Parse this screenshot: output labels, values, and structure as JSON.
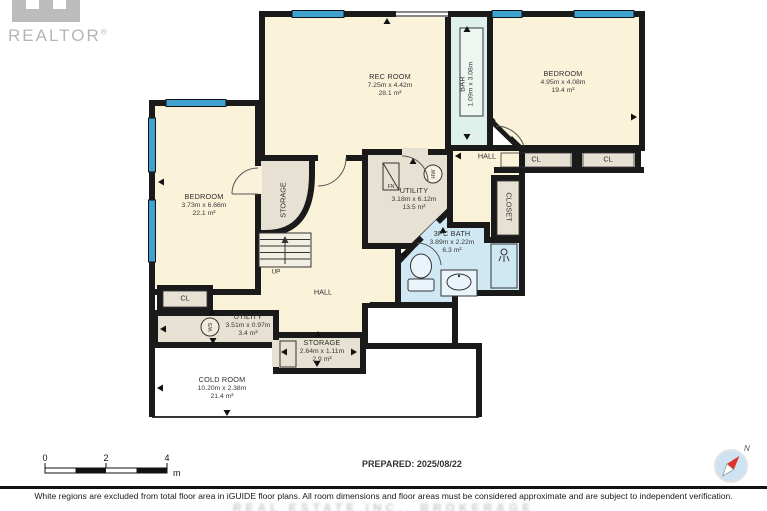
{
  "branding": {
    "realtor": "REALTOR",
    "reg": "®"
  },
  "rooms": {
    "rec_room": {
      "name": "REC ROOM",
      "dims": "7.25m x 4.42m",
      "area": "28.1 m²"
    },
    "bar": {
      "name": "BAR",
      "dims": "1.09m x 3.08m"
    },
    "bedroom_right": {
      "name": "BEDROOM",
      "dims": "4.95m x 4.08m",
      "area": "19.4 m²"
    },
    "bedroom_left": {
      "name": "BEDROOM",
      "dims": "3.73m x 6.66m",
      "area": "22.1 m²"
    },
    "utility_main": {
      "name": "UTILITY",
      "dims": "3.18m x 6.12m",
      "area": "13.5 m²"
    },
    "bath": {
      "name": "3PC BATH",
      "dims": "3.89m x 2.22m",
      "area": "6.3 m²"
    },
    "hall_upper": {
      "name": "HALL"
    },
    "hall_lower": {
      "name": "HALL"
    },
    "closet_hall": {
      "name": "CLOSET"
    },
    "storage_stairs": {
      "name": "STORAGE"
    },
    "storage_bottom": {
      "name": "STORAGE",
      "dims": "2.64m x 1.11m",
      "area": "2.9 m²"
    },
    "utility_bottom": {
      "name": "UTILITY",
      "dims": "3.51m x 0.97m",
      "area": "3.4 m²"
    },
    "cold_room": {
      "name": "COLD ROOM",
      "dims": "10.20m x 2.38m",
      "area": "21.4 m²"
    },
    "closet_right_1": {
      "name": "CL"
    },
    "closet_right_2": {
      "name": "CL"
    },
    "closet_left": {
      "name": "CL"
    },
    "stairs_up": {
      "label": "UP"
    }
  },
  "fixtures": {
    "furnace": "FN",
    "hot_water": "HW",
    "water_softener": "WS"
  },
  "scale_bar": {
    "t0": "0",
    "t2": "2",
    "t4": "4",
    "unit": "m"
  },
  "compass": {
    "north": "N"
  },
  "footer": {
    "prepared": "PREPARED: 2025/08/22",
    "disclaimer": "White regions are excluded from total floor area in iGUIDE floor plans. All room dimensions and floor areas must be considered approximate and are subject to independent verification.",
    "watermark": "REAL ESTATE INC., BROKERAGE"
  },
  "colors": {
    "wall": "#1a1a1a",
    "room_cream": "#fbf2da",
    "room_gray": "#e7e1d3",
    "bath_blue": "#cfe8f4",
    "bar_teal": "#def0ea",
    "window_blue": "#3fa2d1",
    "cold_white": "#ffffff",
    "compass_blue": "#cde3f1",
    "needle_red": "#e03127"
  }
}
